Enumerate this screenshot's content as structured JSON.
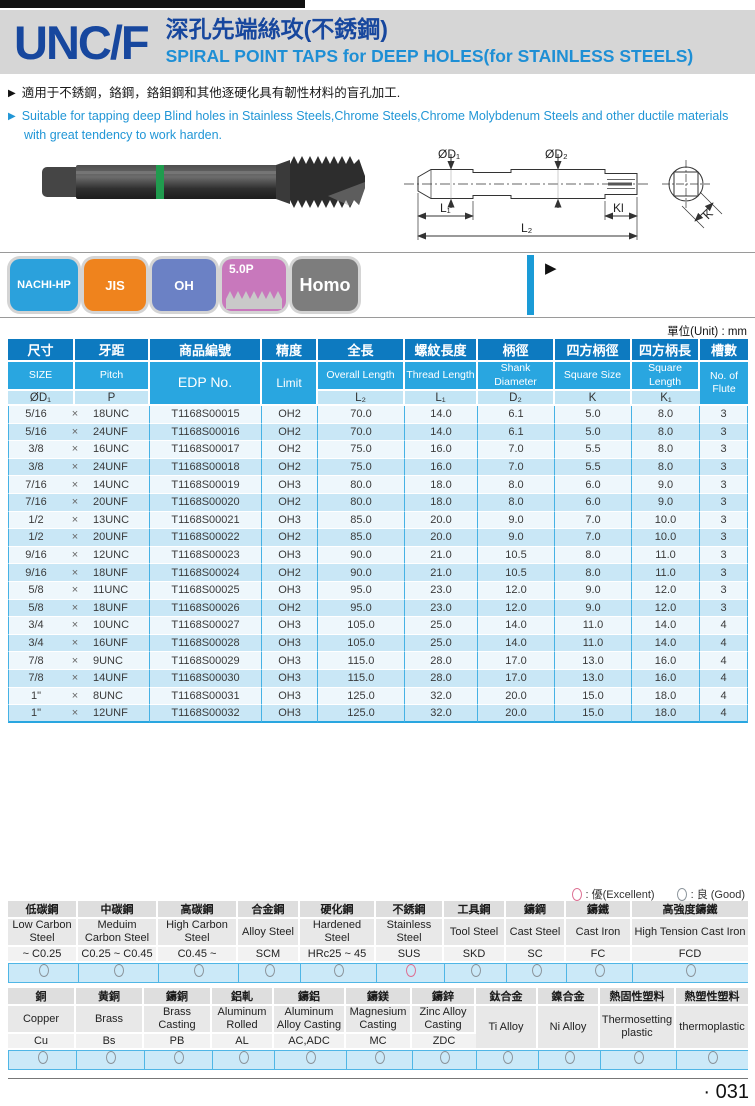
{
  "header": {
    "series": "UNC/F",
    "title_zh": "深孔先端絲攻(不銹鋼)",
    "title_en": "SPIRAL POINT TAPS for DEEP HOLES(for STAINLESS STEELS)"
  },
  "arrow_marker": "▶",
  "bullets": {
    "zh": "適用于不銹鋼，鉻鋼，鉻鉬鋼和其他逐硬化具有韌性材料的盲孔加工.",
    "en": "Suitable for tapping deep Blind holes in Stainless Steels,Chrome Steels,Chrome Molybdenum Steels and other ductile materials with great tendency to work harden."
  },
  "badges": [
    {
      "label": "NACHI-HP",
      "color": "#2ba1dc",
      "profile": false
    },
    {
      "label": "JIS",
      "color": "#ef831d",
      "profile": false
    },
    {
      "label": "OH",
      "color": "#6b81c5",
      "profile": false
    },
    {
      "label": "5.0P",
      "color": "#c878bc",
      "profile": true
    },
    {
      "label": "Homo",
      "color": "#7d7d7d",
      "profile": false
    }
  ],
  "diagram": {
    "d1": "ØD₁",
    "d2": "ØD₂",
    "l1": "L₁",
    "l2": "L₂",
    "kl": "Kl",
    "k": "K"
  },
  "unit_note": "單位(Unit) : mm",
  "table": {
    "separator": "×",
    "headers_zh": [
      "尺寸",
      "牙距",
      "商品編號",
      "精度",
      "全長",
      "螺紋長度",
      "柄徑",
      "四方柄徑",
      "四方柄長",
      "槽數"
    ],
    "headers_en": [
      "SIZE",
      "Pitch",
      "EDP No.",
      "Limit",
      "Overall Length",
      "Thread Length",
      "Shank Diameter",
      "Square Size",
      "Square Length",
      "No. of Flute"
    ],
    "headers_sym": [
      "ØD₁",
      "P",
      "",
      "",
      "L₂",
      "L₁",
      "D₂",
      "K",
      "K₁",
      ""
    ],
    "rows": [
      [
        "5/16",
        "18UNC",
        "T1168S00015",
        "OH2",
        "70.0",
        "14.0",
        "6.1",
        "5.0",
        "8.0",
        "3"
      ],
      [
        "5/16",
        "24UNF",
        "T1168S00016",
        "OH2",
        "70.0",
        "14.0",
        "6.1",
        "5.0",
        "8.0",
        "3"
      ],
      [
        "3/8",
        "16UNC",
        "T1168S00017",
        "OH2",
        "75.0",
        "16.0",
        "7.0",
        "5.5",
        "8.0",
        "3"
      ],
      [
        "3/8",
        "24UNF",
        "T1168S00018",
        "OH2",
        "75.0",
        "16.0",
        "7.0",
        "5.5",
        "8.0",
        "3"
      ],
      [
        "7/16",
        "14UNC",
        "T1168S00019",
        "OH3",
        "80.0",
        "18.0",
        "8.0",
        "6.0",
        "9.0",
        "3"
      ],
      [
        "7/16",
        "20UNF",
        "T1168S00020",
        "OH2",
        "80.0",
        "18.0",
        "8.0",
        "6.0",
        "9.0",
        "3"
      ],
      [
        "1/2",
        "13UNC",
        "T1168S00021",
        "OH3",
        "85.0",
        "20.0",
        "9.0",
        "7.0",
        "10.0",
        "3"
      ],
      [
        "1/2",
        "20UNF",
        "T1168S00022",
        "OH2",
        "85.0",
        "20.0",
        "9.0",
        "7.0",
        "10.0",
        "3"
      ],
      [
        "9/16",
        "12UNC",
        "T1168S00023",
        "OH3",
        "90.0",
        "21.0",
        "10.5",
        "8.0",
        "11.0",
        "3"
      ],
      [
        "9/16",
        "18UNF",
        "T1168S00024",
        "OH2",
        "90.0",
        "21.0",
        "10.5",
        "8.0",
        "11.0",
        "3"
      ],
      [
        "5/8",
        "11UNC",
        "T1168S00025",
        "OH3",
        "95.0",
        "23.0",
        "12.0",
        "9.0",
        "12.0",
        "3"
      ],
      [
        "5/8",
        "18UNF",
        "T1168S00026",
        "OH2",
        "95.0",
        "23.0",
        "12.0",
        "9.0",
        "12.0",
        "3"
      ],
      [
        "3/4",
        "10UNC",
        "T1168S00027",
        "OH3",
        "105.0",
        "25.0",
        "14.0",
        "11.0",
        "14.0",
        "4"
      ],
      [
        "3/4",
        "16UNF",
        "T1168S00028",
        "OH3",
        "105.0",
        "25.0",
        "14.0",
        "11.0",
        "14.0",
        "4"
      ],
      [
        "7/8",
        "9UNC",
        "T1168S00029",
        "OH3",
        "115.0",
        "28.0",
        "17.0",
        "13.0",
        "16.0",
        "4"
      ],
      [
        "7/8",
        "14UNF",
        "T1168S00030",
        "OH3",
        "115.0",
        "28.0",
        "17.0",
        "13.0",
        "16.0",
        "4"
      ],
      [
        "1\"",
        "8UNC",
        "T1168S00031",
        "OH3",
        "125.0",
        "32.0",
        "20.0",
        "15.0",
        "18.0",
        "4"
      ],
      [
        "1\"",
        "12UNF",
        "T1168S00032",
        "OH3",
        "125.0",
        "32.0",
        "20.0",
        "15.0",
        "18.0",
        "4"
      ]
    ]
  },
  "legend": {
    "excellent_label": ": 優(Excellent)",
    "good_label": ": 良 (Good)"
  },
  "colors": {
    "header_dark": "#0d7ac0",
    "header_mid": "#29a6e0",
    "header_light": "#c3e5f5",
    "row_light": "#eef7fc",
    "row_mid": "#c9e7f6",
    "grid_blue": "#46b2e5",
    "accent_bar": "#1a9bd7",
    "excellent": "#dd6f92",
    "good": "#8b949b"
  },
  "materials1": [
    [
      "低碳鋼",
      "Low Carbon Steel",
      "~ C0.25",
      "good"
    ],
    [
      "中碳鋼",
      "Meduim Carbon Steel",
      "C0.25 ~ C0.45",
      "good"
    ],
    [
      "高碳鋼",
      "High Carbon Steel",
      "C0.45 ~",
      "good"
    ],
    [
      "合金鋼",
      "Alloy Steel",
      "SCM",
      "good"
    ],
    [
      "硬化鋼",
      "Hardened Steel",
      "HRc25 ~ 45",
      "good"
    ],
    [
      "不銹鋼",
      "Stainless Steel",
      "SUS",
      "excellent"
    ],
    [
      "工具鋼",
      "Tool Steel",
      "SKD",
      "good"
    ],
    [
      "鑄鋼",
      "Cast Steel",
      "SC",
      "good"
    ],
    [
      "鑄鐵",
      "Cast Iron",
      "FC",
      "good"
    ],
    [
      "高強度鑄鐵",
      "High Tension Cast Iron",
      "FCD",
      "good"
    ]
  ],
  "materials2": [
    [
      "銅",
      "Copper",
      "Cu",
      "good"
    ],
    [
      "黄銅",
      "Brass",
      "Bs",
      "good"
    ],
    [
      "鑄銅",
      "Brass Casting",
      "PB",
      "good"
    ],
    [
      "鋁軋",
      "Aluminum Rolled",
      "AL",
      "good"
    ],
    [
      "鑄鋁",
      "Aluminum Alloy Casting",
      "AC,ADC",
      "good"
    ],
    [
      "鑄鎂",
      "Magnesium Casting",
      "MC",
      "good"
    ],
    [
      "鑄鋅",
      "Zinc Alloy Casting",
      "ZDC",
      "good"
    ],
    [
      "鈦合金",
      "Ti Alloy",
      "",
      "good"
    ],
    [
      "鎳合金",
      "Ni Alloy",
      "",
      "good"
    ],
    [
      "熱固性塑料",
      "Thermosetting plastic",
      "",
      "good"
    ],
    [
      "熱塑性塑料",
      "thermoplastic",
      "",
      "good"
    ]
  ],
  "page_number": "· 031"
}
